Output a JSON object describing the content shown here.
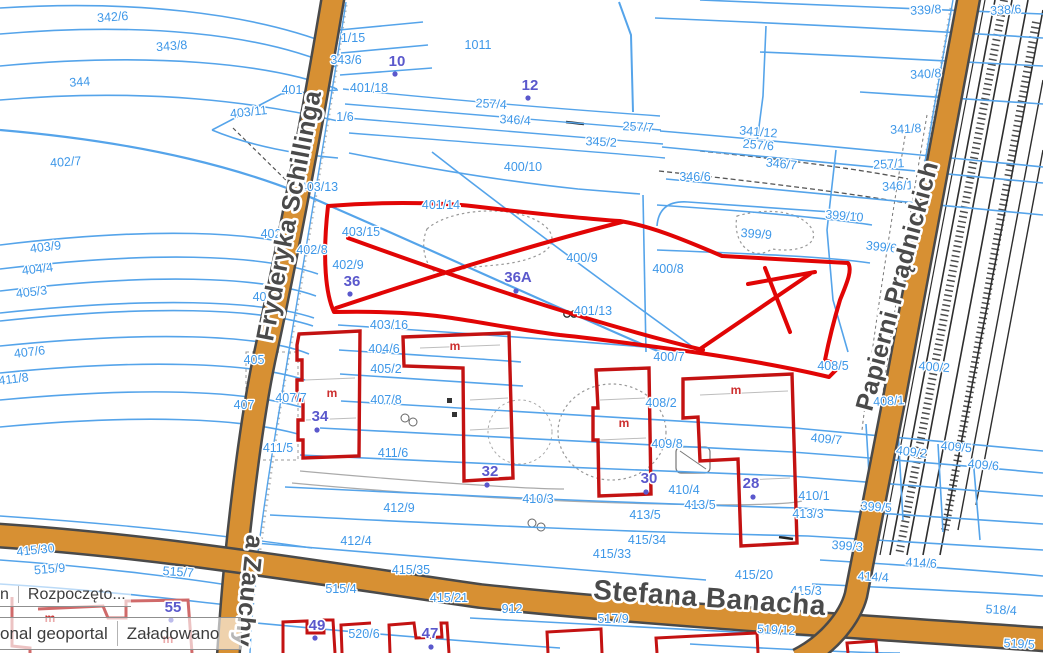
{
  "app": {
    "name": "geoportal map view"
  },
  "status_bars": [
    {
      "left": "n",
      "right": "Rozpoczęto..."
    },
    {
      "left": "onal geoportal",
      "right": "Załadowano"
    }
  ],
  "streets": [
    {
      "name": "Fryderyka Schillinga",
      "x": 297,
      "y": 217,
      "rot": -79,
      "size": 25
    },
    {
      "name": "Papierni Prądnickich",
      "x": 905,
      "y": 288,
      "rot": -75,
      "size": 25
    },
    {
      "name": "Stefana Banacha",
      "x": 709,
      "y": 607,
      "rot": 4,
      "size": 28
    },
    {
      "name": "a Zauchy",
      "x": 241,
      "y": 590,
      "rot": 96,
      "size": 25
    }
  ],
  "parcels": [
    {
      "t": "342/6",
      "x": 113,
      "y": 21,
      "r": -4
    },
    {
      "t": "343/8",
      "x": 172,
      "y": 50,
      "r": -4
    },
    {
      "t": "344",
      "x": 80,
      "y": 86,
      "r": -4
    },
    {
      "t": "402/7",
      "x": 66,
      "y": 166,
      "r": -4
    },
    {
      "t": "403/11",
      "x": 249,
      "y": 116,
      "r": -6
    },
    {
      "t": "403/9",
      "x": 46,
      "y": 251,
      "r": -7
    },
    {
      "t": "404/4",
      "x": 38,
      "y": 273,
      "r": -7
    },
    {
      "t": "405/3",
      "x": 32,
      "y": 296,
      "r": -7
    },
    {
      "t": "407/6",
      "x": 30,
      "y": 356,
      "r": -7
    },
    {
      "t": "411/8",
      "x": 14,
      "y": 383,
      "r": -7
    },
    {
      "t": "415/30",
      "x": 36,
      "y": 554,
      "r": -6
    },
    {
      "t": "515/9",
      "x": 50,
      "y": 573,
      "r": -5
    },
    {
      "t": "515/7",
      "x": 178,
      "y": 576,
      "r": 4
    },
    {
      "t": "1/15",
      "x": 353,
      "y": 42
    },
    {
      "t": "343/6",
      "x": 346,
      "y": 64
    },
    {
      "t": "401",
      "x": 292,
      "y": 94
    },
    {
      "t": "401/18",
      "x": 369,
      "y": 92
    },
    {
      "t": "1/6",
      "x": 345,
      "y": 121
    },
    {
      "t": "1011",
      "x": 478,
      "y": 49
    },
    {
      "t": "257/4",
      "x": 491,
      "y": 108,
      "r": 3
    },
    {
      "t": "346/4",
      "x": 515,
      "y": 124,
      "r": 3
    },
    {
      "t": "345/2",
      "x": 601,
      "y": 146,
      "r": 3
    },
    {
      "t": "257/7",
      "x": 638,
      "y": 131,
      "r": 3
    },
    {
      "t": "339/8",
      "x": 926,
      "y": 14,
      "r": -3
    },
    {
      "t": "338/6",
      "x": 1006,
      "y": 14,
      "r": -3
    },
    {
      "t": "340/8",
      "x": 926,
      "y": 78,
      "r": -3
    },
    {
      "t": "341/12",
      "x": 758,
      "y": 136,
      "r": 5
    },
    {
      "t": "257/6",
      "x": 758,
      "y": 149,
      "r": 5
    },
    {
      "t": "346/7",
      "x": 781,
      "y": 168,
      "r": 6
    },
    {
      "t": "346/6",
      "x": 695,
      "y": 181
    },
    {
      "t": "341/8",
      "x": 906,
      "y": 133,
      "r": -3
    },
    {
      "t": "257/1",
      "x": 889,
      "y": 168,
      "r": -3
    },
    {
      "t": "346/1",
      "x": 898,
      "y": 190,
      "r": -3
    },
    {
      "t": "399/10",
      "x": 844,
      "y": 220,
      "r": 5
    },
    {
      "t": "399/9",
      "x": 756,
      "y": 238,
      "r": 4
    },
    {
      "t": "399/6",
      "x": 881,
      "y": 251,
      "r": 6
    },
    {
      "t": "400/10",
      "x": 523,
      "y": 171
    },
    {
      "t": "401/14",
      "x": 441,
      "y": 209
    },
    {
      "t": "403/15",
      "x": 361,
      "y": 236
    },
    {
      "t": "403/13",
      "x": 319,
      "y": 191
    },
    {
      "t": "402/8",
      "x": 312,
      "y": 254
    },
    {
      "t": "402/9",
      "x": 348,
      "y": 269
    },
    {
      "t": "400/9",
      "x": 582,
      "y": 262
    },
    {
      "t": "400/8",
      "x": 668,
      "y": 273
    },
    {
      "t": "401/13",
      "x": 593,
      "y": 315
    },
    {
      "t": "400/7",
      "x": 669,
      "y": 361
    },
    {
      "t": "408/5",
      "x": 833,
      "y": 370
    },
    {
      "t": "400/2",
      "x": 934,
      "y": 371,
      "r": 4
    },
    {
      "t": "408/1",
      "x": 889,
      "y": 405,
      "r": -3
    },
    {
      "t": "403/16",
      "x": 389,
      "y": 329
    },
    {
      "t": "404/6",
      "x": 384,
      "y": 353
    },
    {
      "t": "405/2",
      "x": 386,
      "y": 373
    },
    {
      "t": "407/8",
      "x": 386,
      "y": 404
    },
    {
      "t": "407/7",
      "x": 291,
      "y": 402
    },
    {
      "t": "407",
      "x": 244,
      "y": 409
    },
    {
      "t": "405",
      "x": 254,
      "y": 364
    },
    {
      "t": "403",
      "x": 263,
      "y": 301
    },
    {
      "t": "402",
      "x": 271,
      "y": 238
    },
    {
      "t": "411/5",
      "x": 278,
      "y": 452
    },
    {
      "t": "411/6",
      "x": 393,
      "y": 457
    },
    {
      "t": "408/2",
      "x": 661,
      "y": 407
    },
    {
      "t": "409/8",
      "x": 667,
      "y": 448
    },
    {
      "t": "410/4",
      "x": 684,
      "y": 494
    },
    {
      "t": "410/3",
      "x": 538,
      "y": 503
    },
    {
      "t": "412/9",
      "x": 399,
      "y": 512
    },
    {
      "t": "412/4",
      "x": 356,
      "y": 545
    },
    {
      "t": "413/5",
      "x": 700,
      "y": 509
    },
    {
      "t": "413/5",
      "x": 645,
      "y": 519
    },
    {
      "t": "415/34",
      "x": 647,
      "y": 544
    },
    {
      "t": "415/33",
      "x": 612,
      "y": 558
    },
    {
      "t": "415/35",
      "x": 411,
      "y": 574
    },
    {
      "t": "415/21",
      "x": 449,
      "y": 602
    },
    {
      "t": "515/4",
      "x": 341,
      "y": 593
    },
    {
      "t": "912",
      "x": 512,
      "y": 613
    },
    {
      "t": "517/9",
      "x": 613,
      "y": 623
    },
    {
      "t": "520/6",
      "x": 364,
      "y": 638
    },
    {
      "t": "409/7",
      "x": 826,
      "y": 443,
      "r": 5
    },
    {
      "t": "409/2",
      "x": 911,
      "y": 456,
      "r": 7
    },
    {
      "t": "409/5",
      "x": 956,
      "y": 451,
      "r": 5
    },
    {
      "t": "409/6",
      "x": 983,
      "y": 469,
      "r": 5
    },
    {
      "t": "410/1",
      "x": 814,
      "y": 500
    },
    {
      "t": "413/3",
      "x": 808,
      "y": 518
    },
    {
      "t": "399/5",
      "x": 876,
      "y": 511,
      "r": 4
    },
    {
      "t": "399/3",
      "x": 847,
      "y": 550,
      "r": 4
    },
    {
      "t": "414/6",
      "x": 921,
      "y": 567,
      "r": 3
    },
    {
      "t": "414/4",
      "x": 873,
      "y": 581,
      "r": 3
    },
    {
      "t": "415/20",
      "x": 754,
      "y": 579
    },
    {
      "t": "415/3",
      "x": 806,
      "y": 595
    },
    {
      "t": "518/4",
      "x": 1001,
      "y": 614,
      "r": 3
    },
    {
      "t": "519/12",
      "x": 776,
      "y": 634,
      "r": 3
    },
    {
      "t": "519/5",
      "x": 1019,
      "y": 648,
      "r": 3
    }
  ],
  "buildings": [
    {
      "t": "10",
      "x": 397,
      "y": 66,
      "dx": 395,
      "dy": 74
    },
    {
      "t": "12",
      "x": 530,
      "y": 90,
      "dx": 528,
      "dy": 98
    },
    {
      "t": "36",
      "x": 352,
      "y": 286,
      "dx": 350,
      "dy": 294
    },
    {
      "t": "36A",
      "x": 518,
      "y": 282,
      "dx": 516,
      "dy": 291
    },
    {
      "t": "34",
      "x": 320,
      "y": 421,
      "dx": 317,
      "dy": 430
    },
    {
      "t": "32",
      "x": 490,
      "y": 476,
      "dx": 487,
      "dy": 485
    },
    {
      "t": "30",
      "x": 649,
      "y": 483,
      "dx": 646,
      "dy": 492
    },
    {
      "t": "28",
      "x": 751,
      "y": 488,
      "dx": 753,
      "dy": 497
    },
    {
      "t": "55",
      "x": 173,
      "y": 612,
      "dx": 171,
      "dy": 620
    },
    {
      "t": "49",
      "x": 317,
      "y": 630,
      "dx": 315,
      "dy": 638
    },
    {
      "t": "47",
      "x": 430,
      "y": 638,
      "dx": 431,
      "dy": 647
    }
  ],
  "house_marks": [
    {
      "t": "m",
      "x": 332,
      "y": 397
    },
    {
      "t": "m",
      "x": 455,
      "y": 350
    },
    {
      "t": "m",
      "x": 624,
      "y": 427
    },
    {
      "t": "m",
      "x": 736,
      "y": 394
    },
    {
      "t": "m",
      "x": 50,
      "y": 622
    },
    {
      "t": "m",
      "x": 168,
      "y": 643
    }
  ],
  "colors": {
    "parcel_line": "#55a4ea",
    "parcel_label": "#3d97e8",
    "building_number": "#5a58cc",
    "road_fill": "#d79033",
    "road_casing": "#4a4a4a",
    "selection_red": "#e10505",
    "building_outline_red": "#c31212",
    "street_label": "#4a4a4a"
  }
}
